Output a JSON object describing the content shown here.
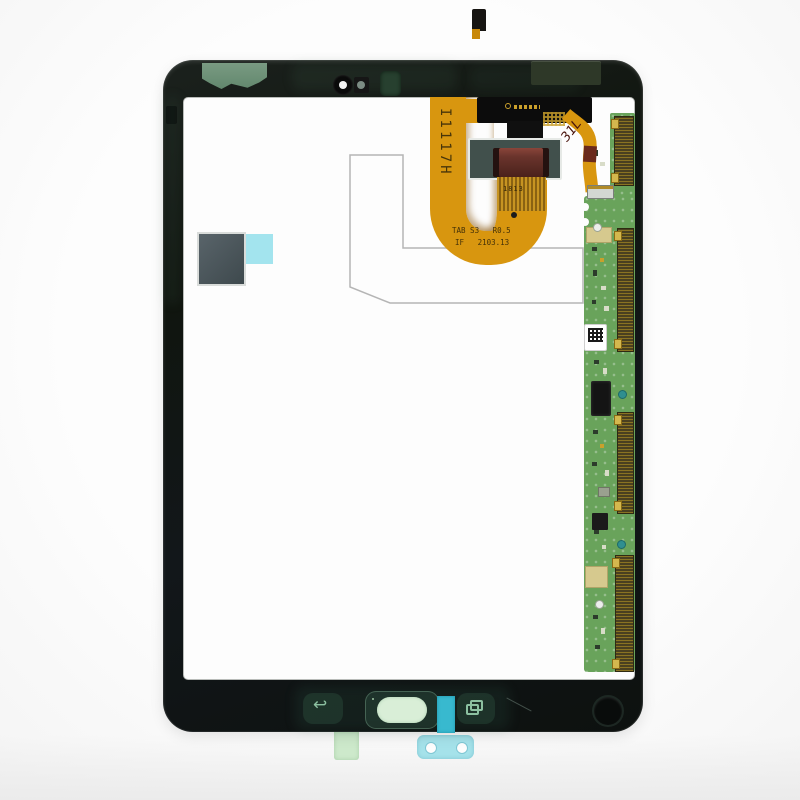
{
  "photo": {
    "description": "Tablet LCD display assembly replacement part with attached flex cable and driver PCB, photographed on a white background"
  },
  "markings": {
    "flex_vertical_code": "I1117H",
    "flex_model_line": "TAB S3   R0.5",
    "flex_revision_line": "IF   2103.13",
    "flex_finger_mark": "1813",
    "handwritten_mark": "31L"
  },
  "icons": {
    "back_button_glyph": "↩"
  },
  "colors": {
    "background": "#fbfbfb",
    "frame_bezel": "#12171a",
    "lcd_panel": "#fdfdfd",
    "flex_copper": "#d8960f",
    "pcb_green": "#69a35b",
    "connector_olive": "#4a4020",
    "connector_brown": "#6a342c",
    "connector_base_slate": "#41504c",
    "tape_cyan_bright": "#38b9cf",
    "tape_cyan_light": "#a5e2ea",
    "tape_mint": "#cde9cb",
    "tape_sage_green": "#86ac90",
    "home_pill_mint": "#d9eed7",
    "dark_square": "#4a5558"
  }
}
